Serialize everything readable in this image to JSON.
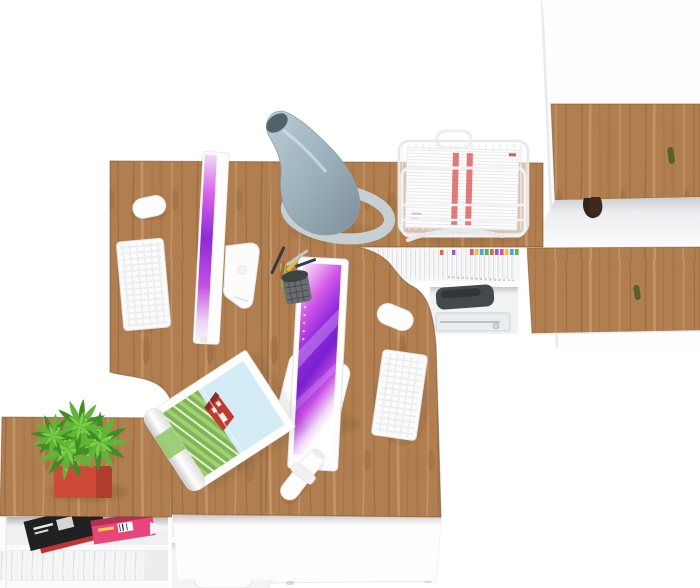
{
  "scene": {
    "title": "Top-down 3D render of a two-person white and oak office workstation",
    "view": "top-down product render",
    "background": "#ffffff"
  },
  "palette": {
    "wood": "#b07e4f",
    "wood_edge": "#7d5531",
    "white": "#fdfdfe",
    "panel_line": "#e4e6e8",
    "lamp_base": "#c6cfd4",
    "lamp_cone_dark": "#52636c",
    "screen_magenta": "#cb4fe8",
    "screen_purple": "#8c26dc",
    "plant_light": "#5fb636",
    "plant_dark": "#3c8f22",
    "plant_inner": "#7ccc4a",
    "pot": "#cd4a38",
    "bag_accent": "#e8714b",
    "mag_pink": "#e8457a",
    "mag_dark": "#202022",
    "mag_red": "#c23434",
    "paper_stripe": "#e06060",
    "knob": "#55602c",
    "book_cream": "#e9dec0",
    "printer": "#46494c",
    "tab_colors": [
      "#e84f8a",
      "#f2c230",
      "#45a6e8",
      "#58b84a",
      "#e8623d",
      "#9b59d0"
    ]
  },
  "objects": {
    "desk": "L-shaped double desk with oak tops and white fronts",
    "wardrobe": "tall white cabinet with oak doors and open cubby",
    "sideboard": "low white sideboard with oak top",
    "lamp": "grey cone desk lamp",
    "monitors": "two all-in-one computers with purple wallpaper",
    "keyboards": "two white wireless keyboards",
    "mice": "two white wireless mice",
    "tray": "white wire document tray with papers",
    "pen_cup": "mesh pencil cup with pens",
    "magazine_open": "open magazine with red house landscape photo",
    "rolled_paper": "rolled white paper with band",
    "plant": "green succulent in red pot",
    "folders": "row of file folders with colored index tabs",
    "printer": "dark compact printer in hutch",
    "books": "row of books in lower cubby",
    "bag": "white tote bag with orange strap",
    "magazines_shelf": "black and pink magazines on shelf"
  }
}
